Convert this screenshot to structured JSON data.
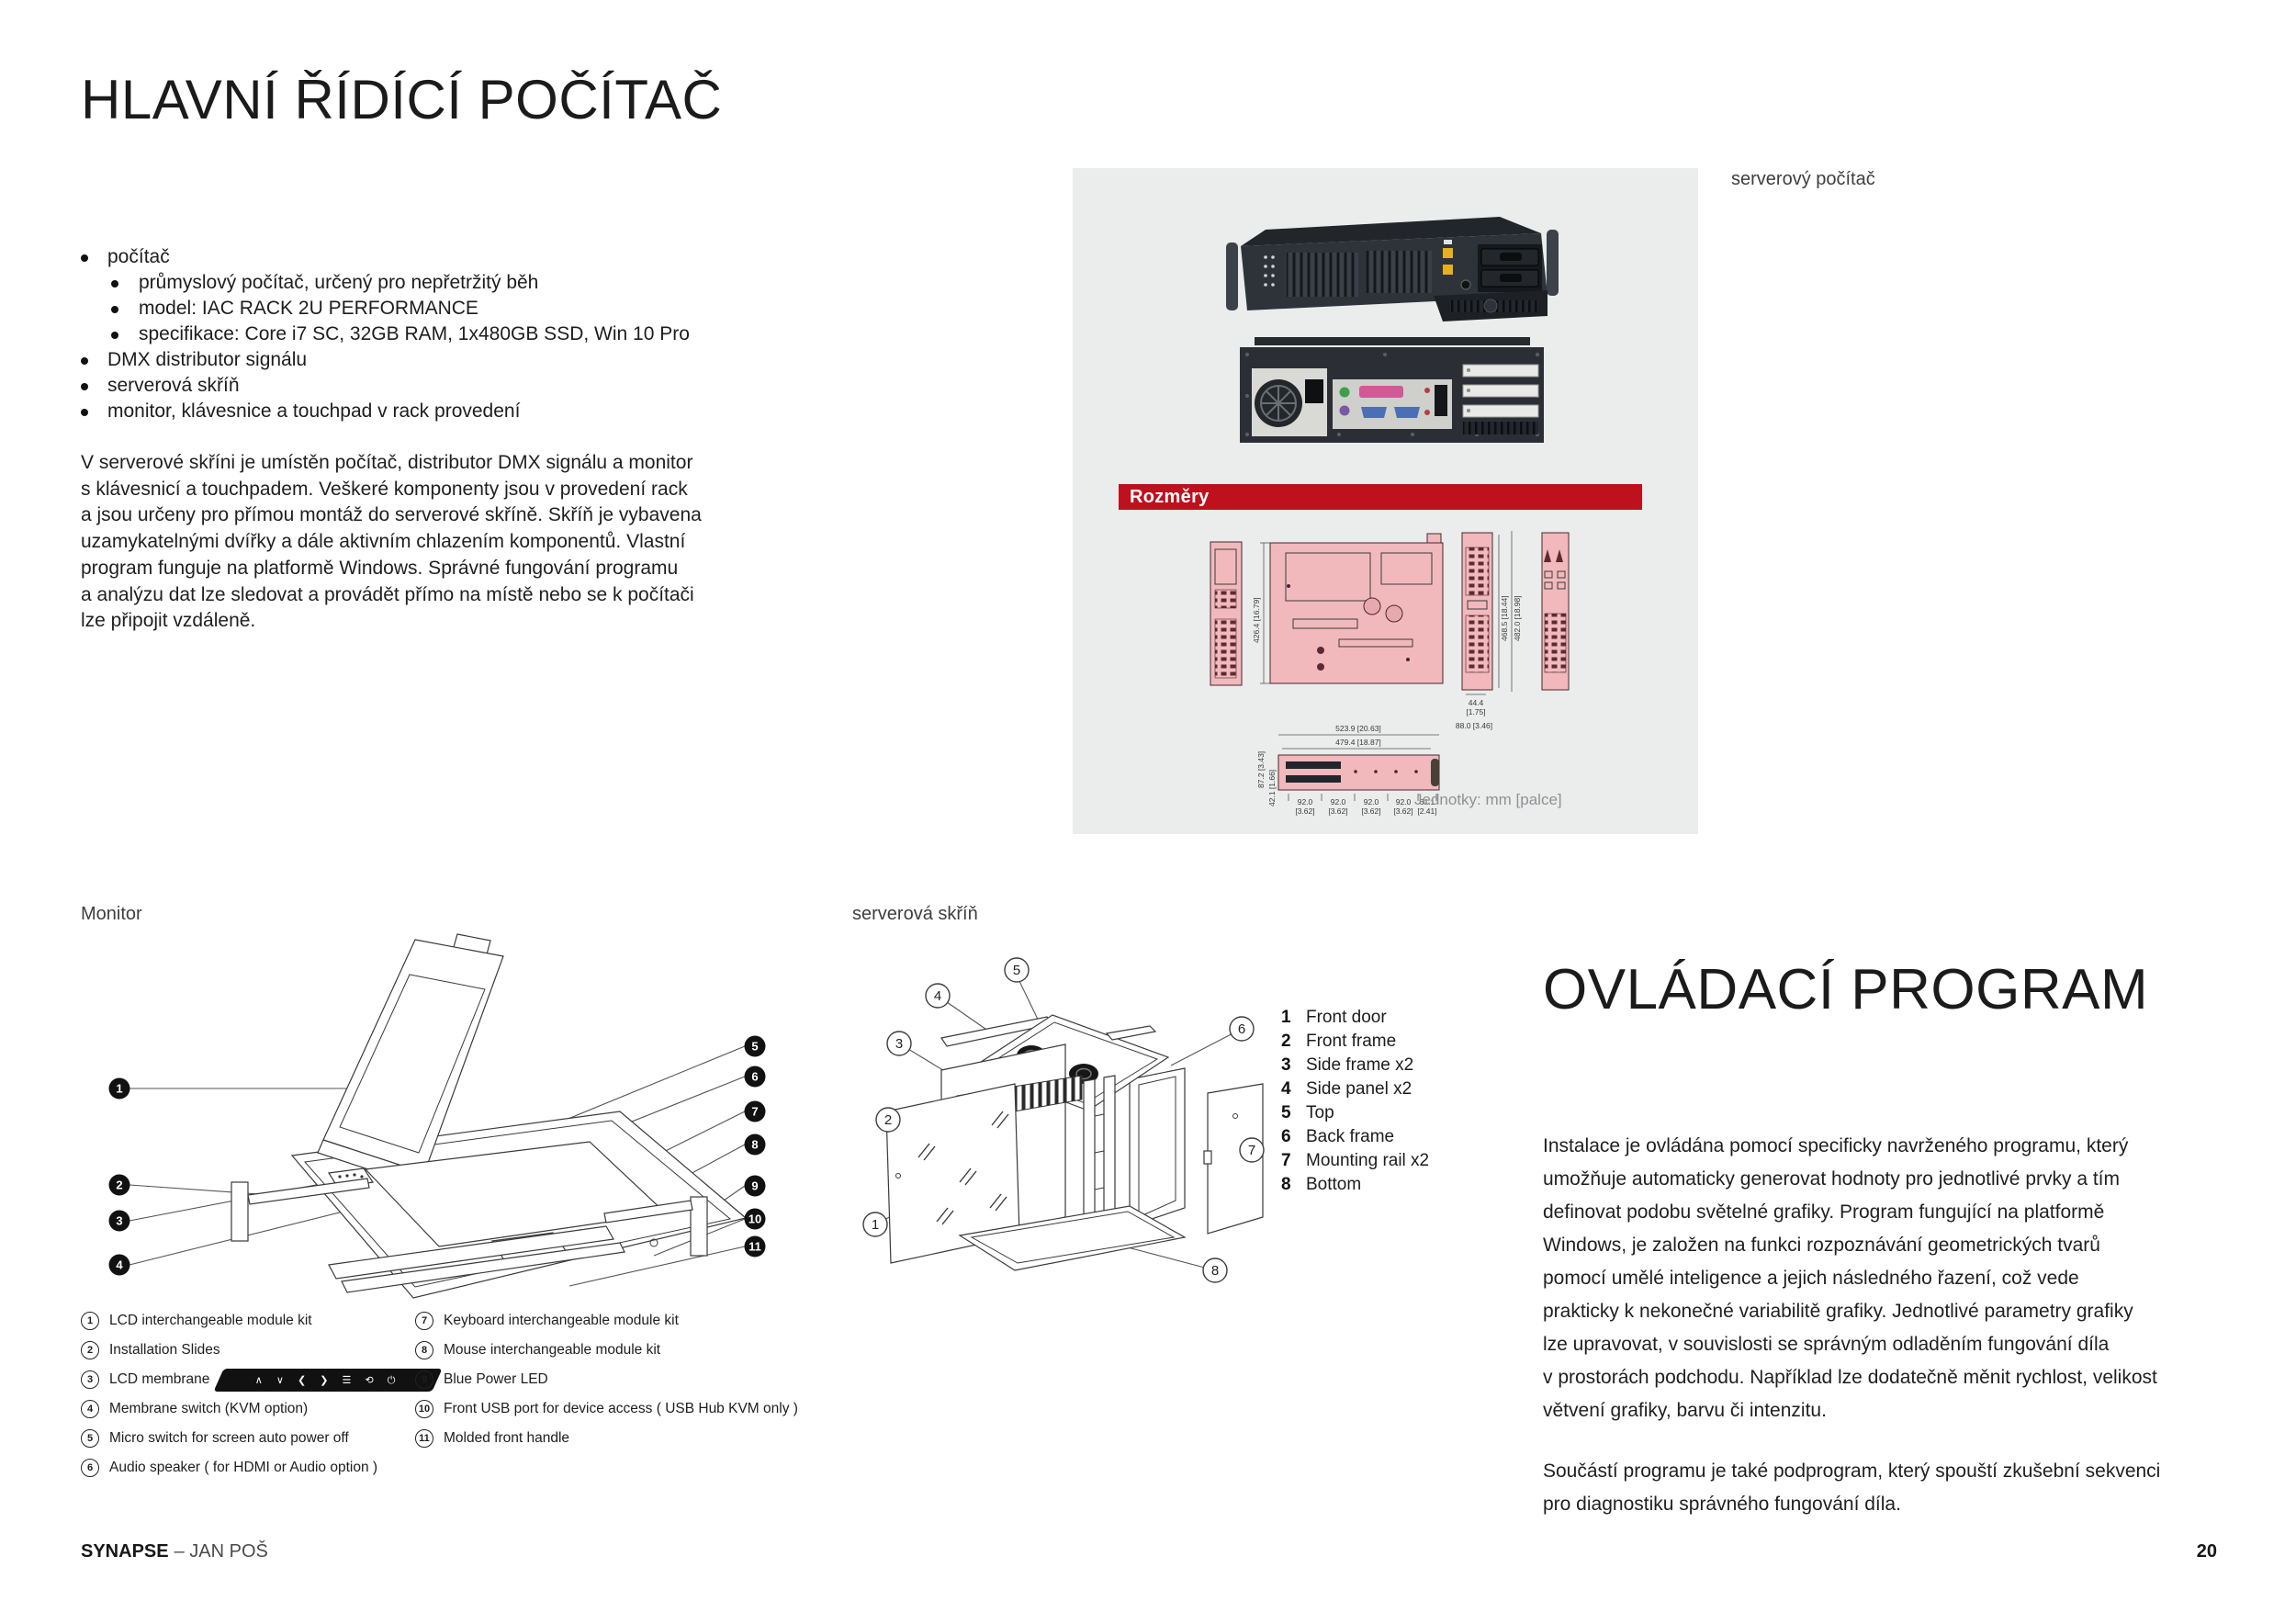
{
  "page": {
    "title": "HLAVNÍ ŘÍDÍCÍ POČÍTAČ",
    "footer_brand": "SYNAPSE",
    "footer_rest": "– JAN POŠ",
    "page_number": "20"
  },
  "intro": {
    "item1": "počítač",
    "sub": [
      "průmyslový počítač, určený pro nepřetržitý běh",
      "model: IAC RACK 2U PERFORMANCE",
      "specifikace: Core i7 SC, 32GB RAM, 1x480GB SSD, Win 10 Pro"
    ],
    "rest": [
      "DMX distributor signálu",
      "serverová skříň",
      "monitor, klávesnice a touchpad v rack provedení"
    ],
    "paragraph_lines": [
      "V serverové skříni je umístěn počítač, distributor DMX signálu a monitor",
      "s klávesnicí a touchpadem. Veškeré komponenty jsou v provedení rack",
      "a jsou určeny pro přímou montáž do serverové skříně. Skříň je vybavena",
      "uzamykatelnými dvířky a dále aktivním chlazením komponentů. Vlastní",
      "program funguje na platformě Windows. Správné fungování programu",
      "a analýzu dat lze sledovat a provádět přímo na místě nebo se k počítači",
      "lze připojit vzdáleně."
    ]
  },
  "server_panel": {
    "caption": "serverový počítač",
    "dimensions_header": "Rozměry",
    "units_note": "Jednotky: mm [palce]",
    "dims": {
      "top_height": "426.4 [16.79]",
      "side_inner": "468.5 [18.44]",
      "side_outer": "482.0 [18.98]",
      "w44": "44.4",
      "w44_in": "[1.75]",
      "w88": "88.0 [3.46]",
      "front_outer": "523.9 [20.63]",
      "front_inner": "479.4 [18.87]",
      "front_h": "87.2 [3.43]",
      "front_h2": "42.1 [1.66]",
      "seg": "92.0",
      "seg_in": "[3.62]",
      "seg_last": "61.1",
      "seg_last_in": "[2.41]"
    }
  },
  "monitor": {
    "caption": "Monitor",
    "callouts": [
      "1",
      "2",
      "3",
      "4",
      "5",
      "6",
      "7",
      "8",
      "9",
      "10",
      "11"
    ],
    "membrane_symbols": "∧ ∨ ❮ ❯ ☰ ⟲  ⏻",
    "legend_left": [
      {
        "n": "1",
        "label": "LCD interchangeable module kit"
      },
      {
        "n": "2",
        "label": "Installation Slides"
      },
      {
        "n": "3",
        "label": "LCD membrane"
      },
      {
        "n": "4",
        "label": "Membrane switch (KVM option)"
      },
      {
        "n": "5",
        "label": "Micro switch for screen auto power off"
      },
      {
        "n": "6",
        "label": "Audio speaker ( for HDMI or Audio option )"
      }
    ],
    "legend_right": [
      {
        "n": "7",
        "label": "Keyboard interchangeable module kit"
      },
      {
        "n": "8",
        "label": "Mouse interchangeable module kit"
      },
      {
        "n": "9",
        "label": "Blue Power LED"
      },
      {
        "n": "10",
        "label": "Front USB port for device access ( USB Hub KVM only )"
      },
      {
        "n": "11",
        "label": "Molded front handle"
      }
    ]
  },
  "cabinet": {
    "caption": "serverová skříň",
    "callouts": [
      "1",
      "2",
      "3",
      "4",
      "5",
      "6",
      "7",
      "8"
    ],
    "legend": [
      {
        "n": "1",
        "label": "Front door"
      },
      {
        "n": "2",
        "label": "Front frame"
      },
      {
        "n": "3",
        "label": "Side frame x2"
      },
      {
        "n": "4",
        "label": "Side panel x2"
      },
      {
        "n": "5",
        "label": "Top"
      },
      {
        "n": "6",
        "label": "Back frame"
      },
      {
        "n": "7",
        "label": "Mounting rail x2"
      },
      {
        "n": "8",
        "label": "Bottom"
      }
    ]
  },
  "program": {
    "title": "OVLÁDACÍ PROGRAM",
    "paragraph1_lines": [
      "Instalace je ovládána pomocí specificky navrženého programu, který",
      "umožňuje automaticky generovat hodnoty pro jednotlivé prvky a tím",
      "definovat podobu světelné grafiky. Program fungující na platformě",
      "Windows, je založen na funkci rozpoznávání geometrických tvarů",
      "pomocí umělé inteligence a jejich následného řazení, což vede",
      "prakticky k nekonečné variabilitě grafiky. Jednotlivé parametry grafiky",
      "lze upravovat, v souvislosti se správným odladěním fungování díla",
      "v prostorách podchodu. Například lze dodatečně měnit rychlost, velikost",
      "větvení grafiky, barvu či intenzitu."
    ],
    "paragraph2_lines": [
      "Součástí programu je také podprogram, který spouští zkušební sekvenci",
      "pro diagnostiku správného fungování díla."
    ]
  },
  "colors": {
    "accent_red": "#bf101e",
    "panel_gray": "#ebecec",
    "drawing_pink": "#f2b9bd"
  }
}
